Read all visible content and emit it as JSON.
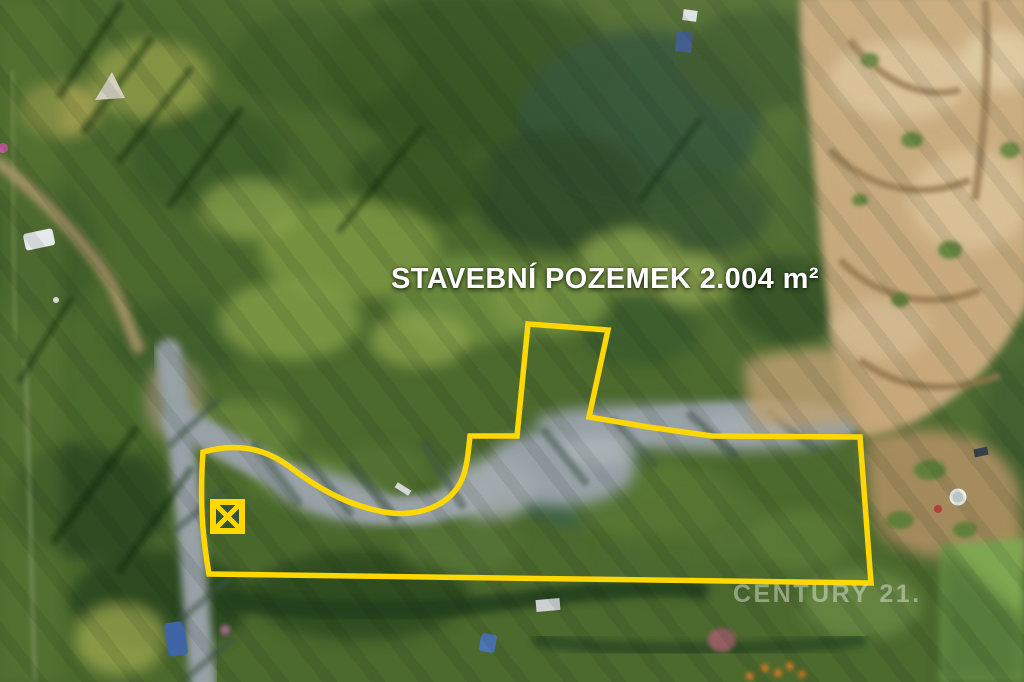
{
  "overlay": {
    "title": "STAVEBNÍ POZEMEK 2.004 m²",
    "watermark": "CENTURY 21.",
    "title_color": "#ffffff",
    "boundary_color": "#ffd703",
    "boundary_stroke_width": 5.5,
    "boundary_path": "M203,452 C235,443 263,447 290,467 C316,487 346,505 384,512 C421,518 448,504 459,485 C467,472 468,454 470,436 L517,436 L528,324 L608,330 L589,417 L648,427 L712,436 L860,437 L871,583 L209,574 C204,545 199,510 203,452 Z",
    "marker": {
      "shape": "boxed-x",
      "x": 213,
      "y": 502,
      "size": 29,
      "stroke_width": 6
    }
  }
}
